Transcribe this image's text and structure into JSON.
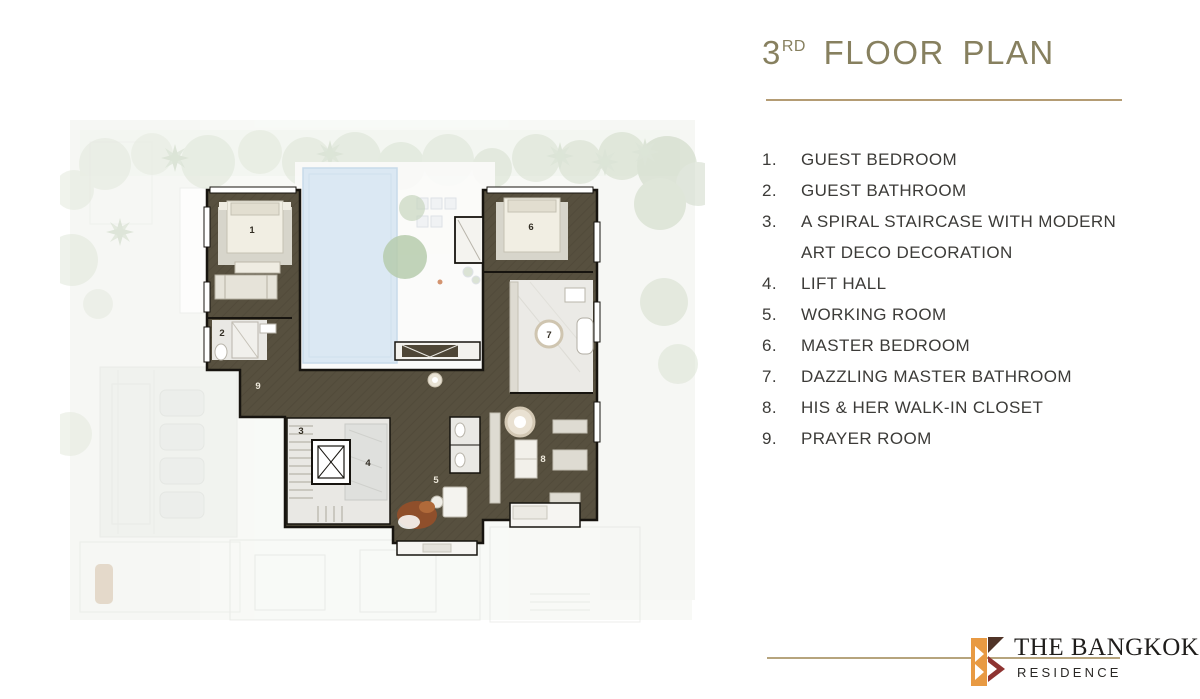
{
  "title": {
    "floor_number": "3",
    "ordinal": "RD",
    "label": "FLOOR PLAN"
  },
  "legend": {
    "items": [
      {
        "num": "1.",
        "label": "GUEST BEDROOM"
      },
      {
        "num": "2.",
        "label": "GUEST BATHROOM"
      },
      {
        "num": "3.",
        "label": "A SPIRAL STAIRCASE WITH MODERN\nART DECO DECORATION"
      },
      {
        "num": "4.",
        "label": "LIFT HALL"
      },
      {
        "num": "5.",
        "label": "WORKING ROOM"
      },
      {
        "num": "6.",
        "label": "MASTER BEDROOM"
      },
      {
        "num": "7.",
        "label": "DAZZLING MASTER BATHROOM"
      },
      {
        "num": "8.",
        "label": "HIS & HER WALK-IN CLOSET"
      },
      {
        "num": "9.",
        "label": "PRAYER ROOM"
      }
    ]
  },
  "floor_plan": {
    "room_numbers": {
      "r1": "1",
      "r2": "2",
      "r3": "3",
      "r4": "4",
      "r5": "5",
      "r6": "6",
      "r7": "7",
      "r8": "8",
      "r9": "9"
    }
  },
  "logo": {
    "name": "THE BANGKOK",
    "sub": "RESIDENCE"
  },
  "colors": {
    "title_text": "#87805f",
    "divider": "#b49c74",
    "legend_text": "#3c3b38",
    "plan_room_fill": "#57503f",
    "plan_wall": "#17140f",
    "pool": "#dbe8f3",
    "logo_orange": "#e89a43",
    "logo_maroon": "#8e3331",
    "logo_dark_brown": "#503428",
    "logo_line": "#b6a47d",
    "logo_text": "#1f1d1b"
  }
}
